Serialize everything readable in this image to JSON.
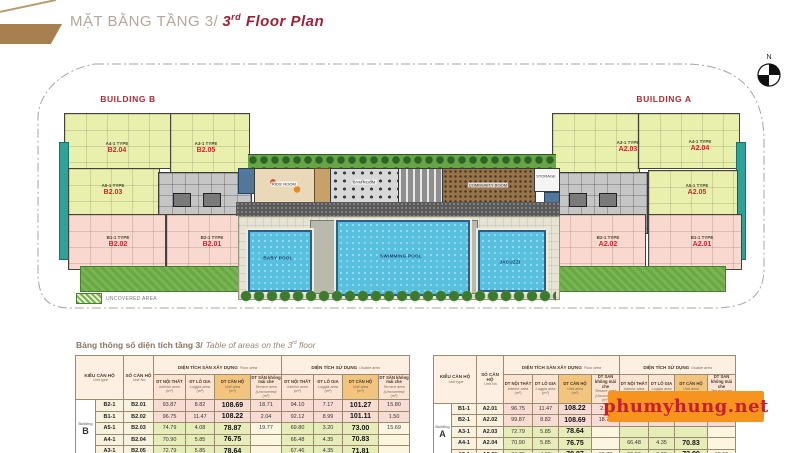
{
  "header": {
    "title_vi": "MẶT BẰNG TẦNG 3/",
    "en_pre": "3",
    "en_sup": "rd",
    "en_post": " Floor Plan"
  },
  "plan": {
    "building_b_label": "BUILDING B",
    "building_a_label": "BUILDING A",
    "compass_n": "N",
    "legend_label": "UNCOVERED AREA",
    "rooms": {
      "kids": "KIDS' ROOM",
      "gym": "GYM ROOM",
      "community": "COMMUNITY ROOM",
      "storage": "STORAGE",
      "baby_pool": "BABY POOL",
      "swimming_pool": "SWIMMING POOL",
      "jacuzzi": "JACUZZI"
    },
    "units_b": [
      {
        "type": "A4-1 TYPE",
        "no": "B2.04"
      },
      {
        "type": "A3-1 TYPE",
        "no": "B2.05"
      },
      {
        "type": "A5-1 TYPE",
        "no": "B2.03"
      },
      {
        "type": "B1-1 TYPE",
        "no": "B2.02"
      },
      {
        "type": "B2-1 TYPE",
        "no": "B2.01"
      }
    ],
    "units_a": [
      {
        "type": "A3-1 TYPE",
        "no": "A2.03"
      },
      {
        "type": "A4-1 TYPE",
        "no": "A2.04"
      },
      {
        "type": "A5-1 TYPE",
        "no": "A2.05"
      },
      {
        "type": "B2-1 TYPE",
        "no": "A2.02"
      },
      {
        "type": "B1-1 TYPE",
        "no": "A2.01"
      }
    ]
  },
  "table_section": {
    "title_vi": "Bảng thông số diện tích tầng 3/",
    "en_pre": "Table of areas on the 3",
    "en_sup": "rd",
    "en_post": " floor"
  },
  "table_headers": {
    "unit_type": "KIỂU CĂN HỘ",
    "unit_type_en": "Unit type",
    "unit_no": "SỐ CĂN HỘ",
    "unit_no_en": "Unit No.",
    "floor_group": "DIỆN TÍCH SÀN XÂY DỰNG",
    "floor_group_en": "Floor area",
    "usable_group": "DIỆN TÍCH SỬ DỤNG",
    "usable_group_en": "Usable area",
    "unit_label": "(m²)",
    "sub": [
      {
        "vi": "DT NỘI THẤT",
        "en": "Interior area"
      },
      {
        "vi": "DT LÔ GIA",
        "en": "Loggia area"
      },
      {
        "vi": "DT CĂN HỘ",
        "en": "Unit area"
      },
      {
        "vi": "DT SÂN không mái che",
        "en": "Terrace area (Uncovered)"
      }
    ]
  },
  "building_b_table": {
    "building": "Building B",
    "rows": [
      {
        "type": "B2-1",
        "no": "B2.01",
        "tone": "pink",
        "v": [
          "93.87",
          "8.82",
          "108.69",
          "18.71",
          "94.10",
          "7.17",
          "101.27",
          "15.80"
        ]
      },
      {
        "type": "B1-1",
        "no": "B2.02",
        "tone": "pink",
        "v": [
          "96.75",
          "11.47",
          "108.22",
          "2.04",
          "92.12",
          "8.99",
          "101.11",
          "1.50"
        ]
      },
      {
        "type": "A5-1",
        "no": "B2.03",
        "tone": "green",
        "v": [
          "74.79",
          "4.08",
          "78.87",
          "19.77",
          "69.80",
          "3.20",
          "73.00",
          "15.69"
        ]
      },
      {
        "type": "A4-1",
        "no": "B2.04",
        "tone": "green",
        "v": [
          "70.90",
          "5.85",
          "76.75",
          "",
          "66.48",
          "4.35",
          "70.83",
          ""
        ]
      },
      {
        "type": "A3-1",
        "no": "B2.05",
        "tone": "green",
        "v": [
          "72.79",
          "5.85",
          "78.64",
          "",
          "67.46",
          "4.35",
          "71.81",
          ""
        ]
      }
    ]
  },
  "building_a_table": {
    "building": "Building A",
    "rows": [
      {
        "type": "B1-1",
        "no": "A2.01",
        "tone": "pink",
        "v": [
          "96.75",
          "11.47",
          "108.22",
          "2.04",
          "",
          "",
          "",
          ""
        ]
      },
      {
        "type": "B2-1",
        "no": "A2.02",
        "tone": "pink",
        "v": [
          "99.87",
          "8.82",
          "108.69",
          "18.71",
          "",
          "",
          "",
          ""
        ]
      },
      {
        "type": "A3-1",
        "no": "A2.03",
        "tone": "green",
        "v": [
          "72.79",
          "5.85",
          "78.64",
          "",
          "",
          "",
          "",
          ""
        ]
      },
      {
        "type": "A4-1",
        "no": "A2.04",
        "tone": "green",
        "v": [
          "70.90",
          "5.85",
          "76.75",
          "",
          "66.48",
          "4.35",
          "70.83",
          ""
        ]
      },
      {
        "type": "A5-1",
        "no": "A2.05",
        "tone": "green",
        "v": [
          "74.79",
          "4.08",
          "78.87",
          "19.77",
          "69.80",
          "3.20",
          "73.00",
          "15.69"
        ]
      }
    ]
  },
  "watermark": {
    "text": "phumyhung.net",
    "bg": "#F7941D",
    "color": "#C41E2F"
  },
  "colors": {
    "accent_red": "#D2232A",
    "building_label": "#B3282D",
    "unit_yellow": "#E9EFAD",
    "unit_pink": "#F8D8CF",
    "teal": "#2EA299",
    "pool_blue": "#58C0DE",
    "banner_tan": "#A87F4F"
  }
}
